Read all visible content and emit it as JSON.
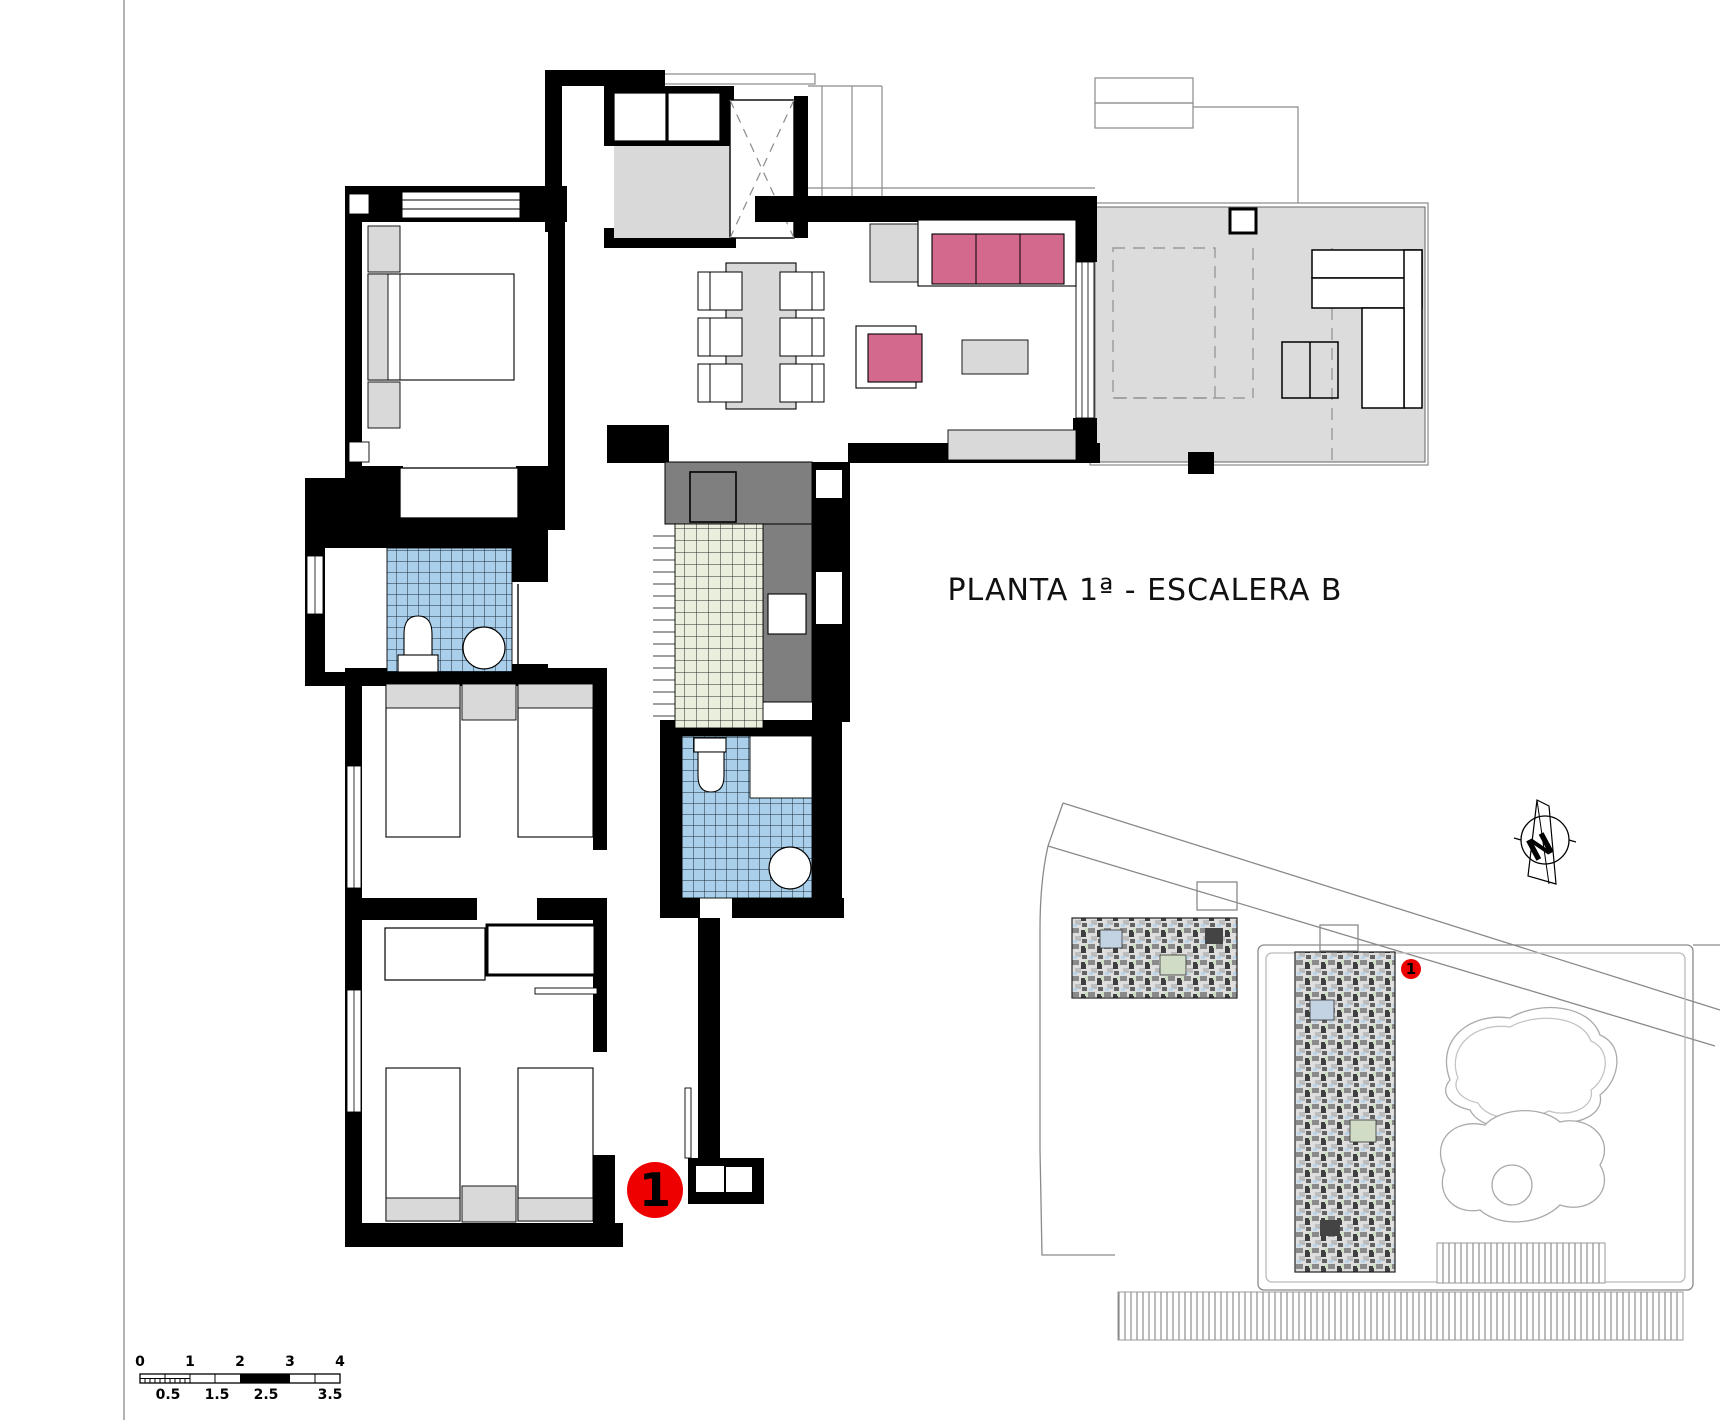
{
  "title": {
    "text": "PLANTA 1ª - ESCALERA B"
  },
  "badges": {
    "unit_number": "1",
    "site_unit_number": "1"
  },
  "compass": {
    "north_label": "N"
  },
  "scale_bar": {
    "top_labels": [
      "0",
      "1",
      "2",
      "3",
      "4"
    ],
    "bottom_labels": [
      "0.5",
      "1.5",
      "2.5",
      "3.5"
    ]
  },
  "colors": {
    "wall_black": "#000000",
    "accent_pink": "#d4698e",
    "marker_red": "#ee0000",
    "tile_blue": "#a9cfea",
    "tile_green": "#e9efdc",
    "floor_gray": "#dcdcdc",
    "furniture_gray": "#d9d9d9",
    "counter_gray": "#7f7f7f"
  }
}
